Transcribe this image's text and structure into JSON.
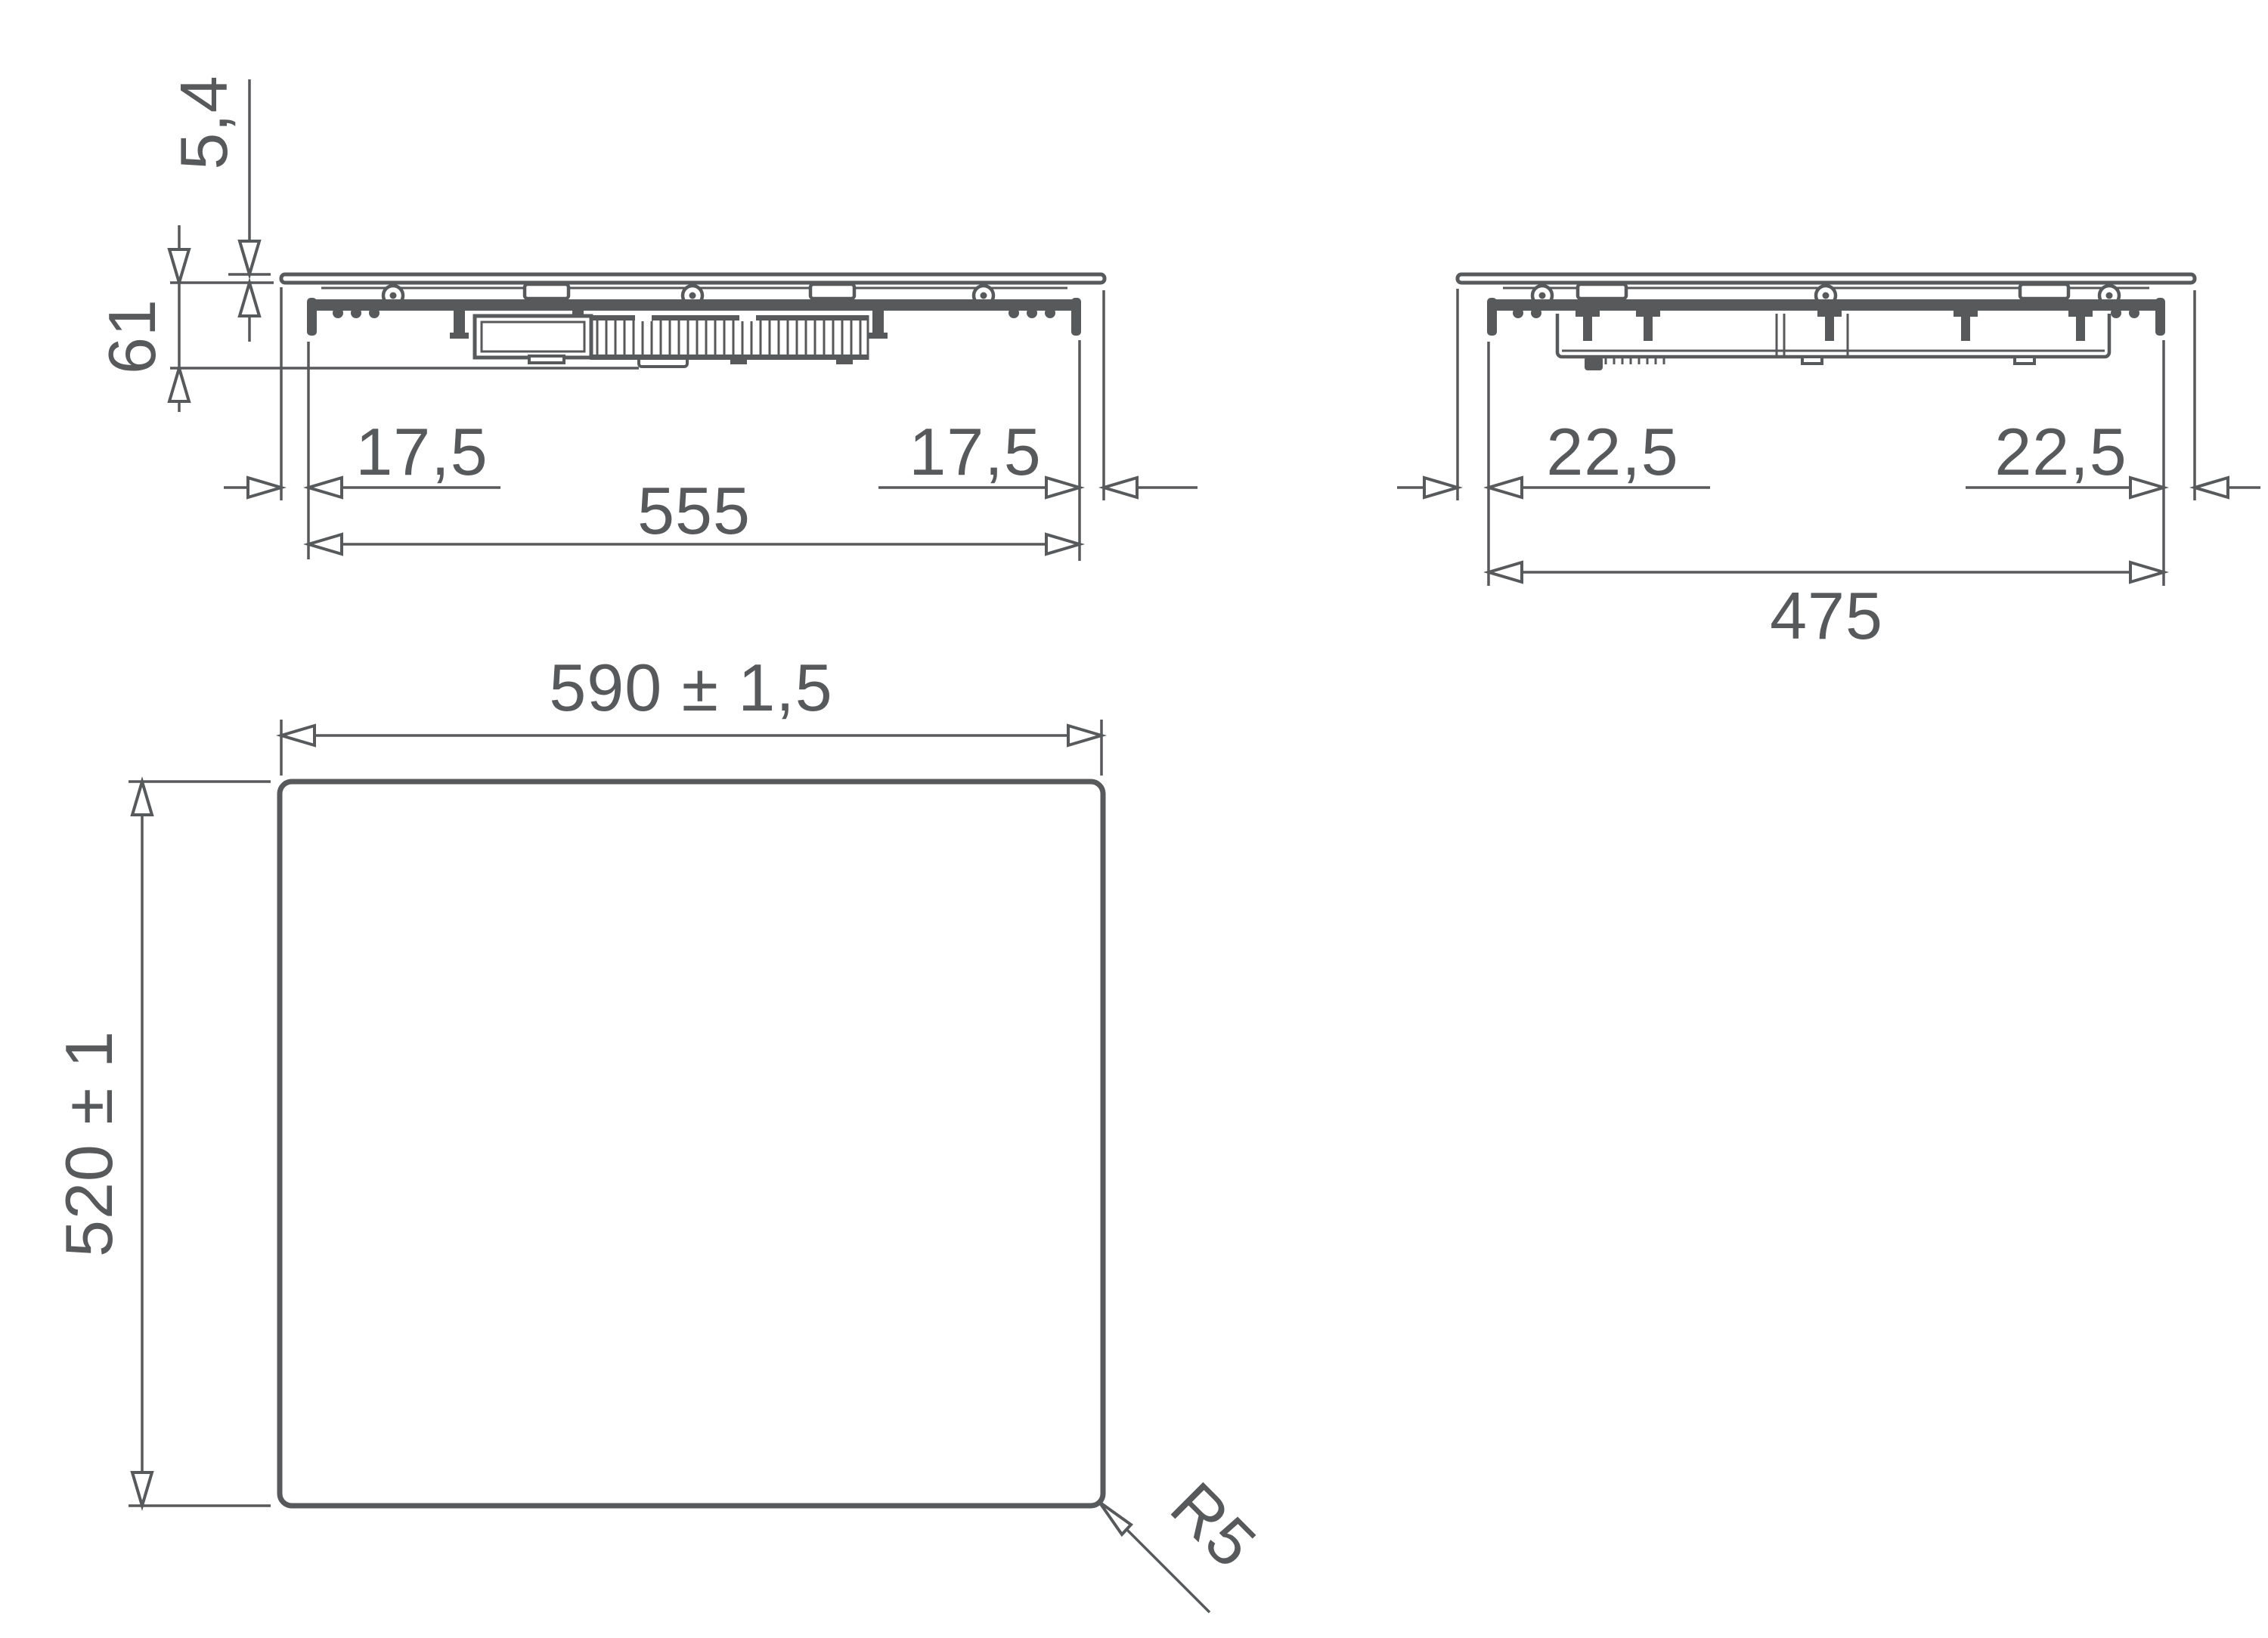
{
  "colors": {
    "line": "#58595b",
    "background": "#ffffff"
  },
  "front_section_view": {
    "dims": {
      "glass_thickness": "5,4",
      "built_in_depth": "61",
      "left_overhang": "17,5",
      "body_width": "555",
      "right_overhang": "17,5"
    }
  },
  "side_section_view": {
    "dims": {
      "left_overhang": "22,5",
      "body_depth": "475",
      "right_overhang": "22,5"
    }
  },
  "plan_view": {
    "dims": {
      "overall_width": "590 ± 1,5",
      "overall_depth": "520 ± 1",
      "corner_radius": "R5"
    }
  }
}
